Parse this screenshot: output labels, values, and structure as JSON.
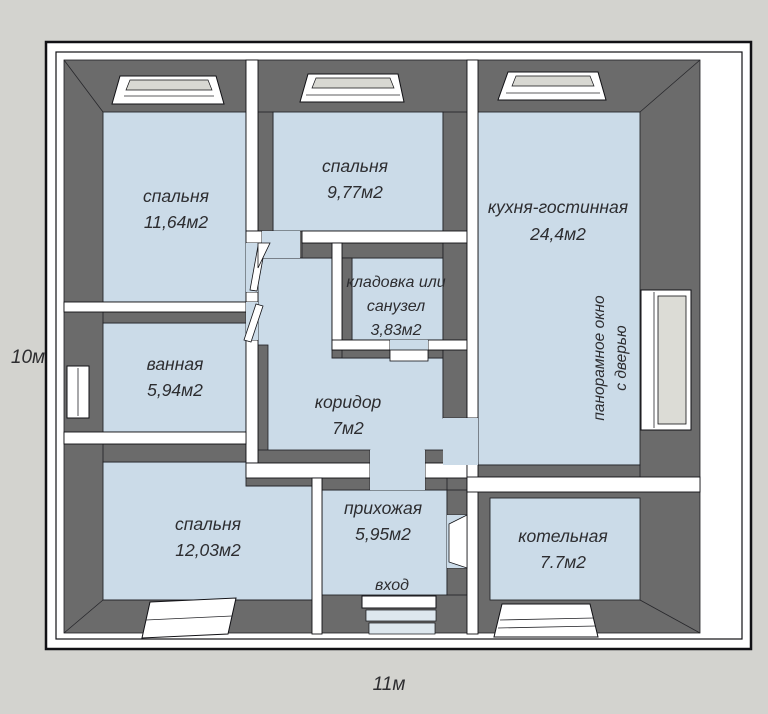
{
  "colors": {
    "background": "#d3d3cf",
    "wall_face": "#6b6b6b",
    "wall_top": "#ffffff",
    "floor": "#cbdbe8",
    "outline": "#111115",
    "window_glass": "#dcdcd6"
  },
  "dimension_labels": {
    "left": "10м",
    "bottom": "11м"
  },
  "entrance": {
    "label": "вход"
  },
  "rooms": [
    {
      "id": "bedroom-top-left",
      "lines": [
        "спальня",
        "11,64м2"
      ]
    },
    {
      "id": "bedroom-top-middle",
      "lines": [
        "спальня",
        "9,77м2"
      ]
    },
    {
      "id": "kitchen-living-room",
      "lines": [
        "кухня-гостинная",
        "24,4м2"
      ]
    },
    {
      "id": "storage-or-bathroom",
      "lines": [
        "кладовка или",
        "санузел",
        "3,83м2"
      ]
    },
    {
      "id": "bathroom",
      "lines": [
        "ванная",
        "5,94м2"
      ]
    },
    {
      "id": "corridor",
      "lines": [
        "коридор",
        "7м2"
      ]
    },
    {
      "id": "bedroom-bottom-left",
      "lines": [
        "спальня",
        "12,03м2"
      ]
    },
    {
      "id": "hallway",
      "lines": [
        "прихожая",
        "5,95м2"
      ]
    },
    {
      "id": "boiler-room",
      "lines": [
        "котельная",
        "7.7м2"
      ]
    }
  ],
  "window_note": {
    "lines": [
      "панорамное окно",
      "с дверью"
    ]
  }
}
